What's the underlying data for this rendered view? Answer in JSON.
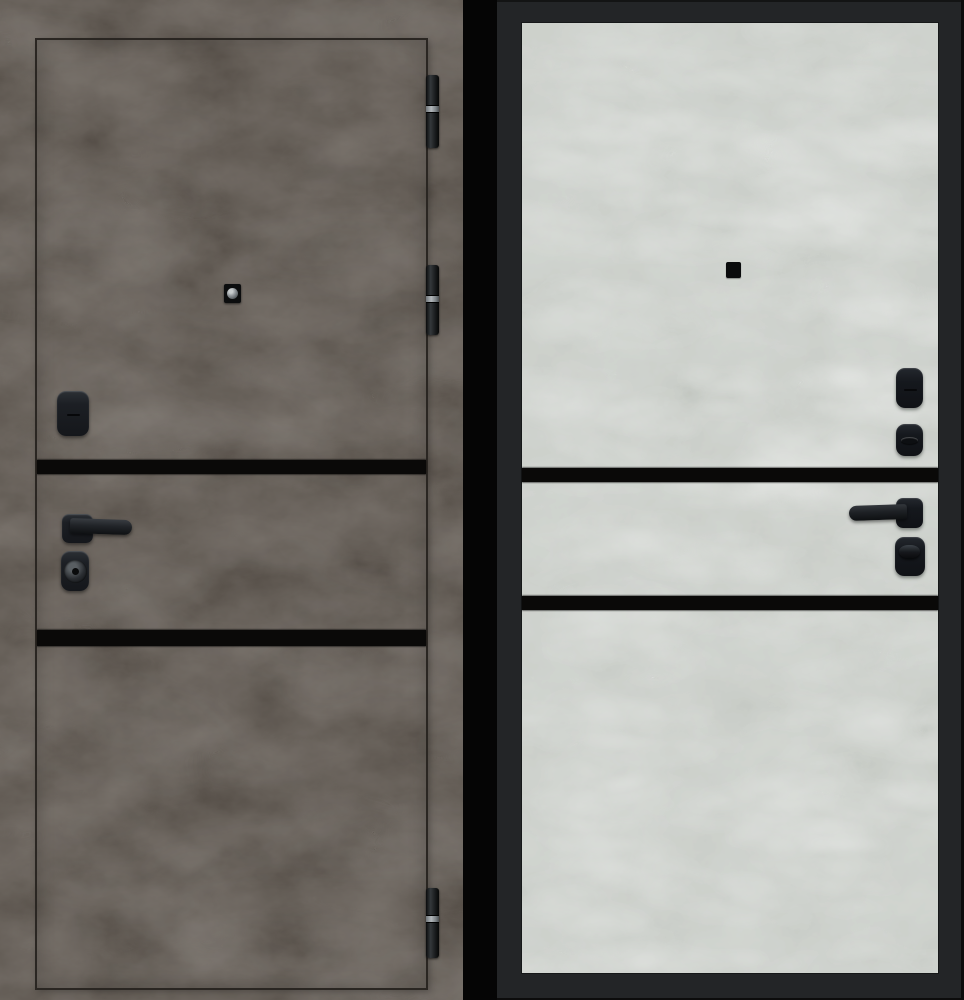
{
  "image": {
    "kind": "product-photo",
    "subject": "steel-entry-door-both-sides"
  },
  "colors": {
    "gap-black": "#050505",
    "stone-dark": "#59524b",
    "stone-dark-line": "#2a2622",
    "stone-light": "#d7dad6",
    "frame-dark": "#232527",
    "stripe-black": "#0a0908",
    "hardware-black": "#1e2126",
    "hinge-ring": "#b2b7bb",
    "lens-grey": "#8d9296"
  },
  "panels": {
    "left": {
      "name": "exterior-side",
      "finish": "dark-grey-stone",
      "accent_stripes": 2,
      "hinges": 3,
      "hardware": [
        "peephole",
        "keyhole-cover",
        "lever-handle",
        "lock-cylinder"
      ]
    },
    "right": {
      "name": "interior-side",
      "finish": "light-grey-stone",
      "accent_stripes": 2,
      "hardware": [
        "peephole",
        "keyhole-cover",
        "thumbturn",
        "lever-handle",
        "lock-thumbturn"
      ]
    }
  }
}
